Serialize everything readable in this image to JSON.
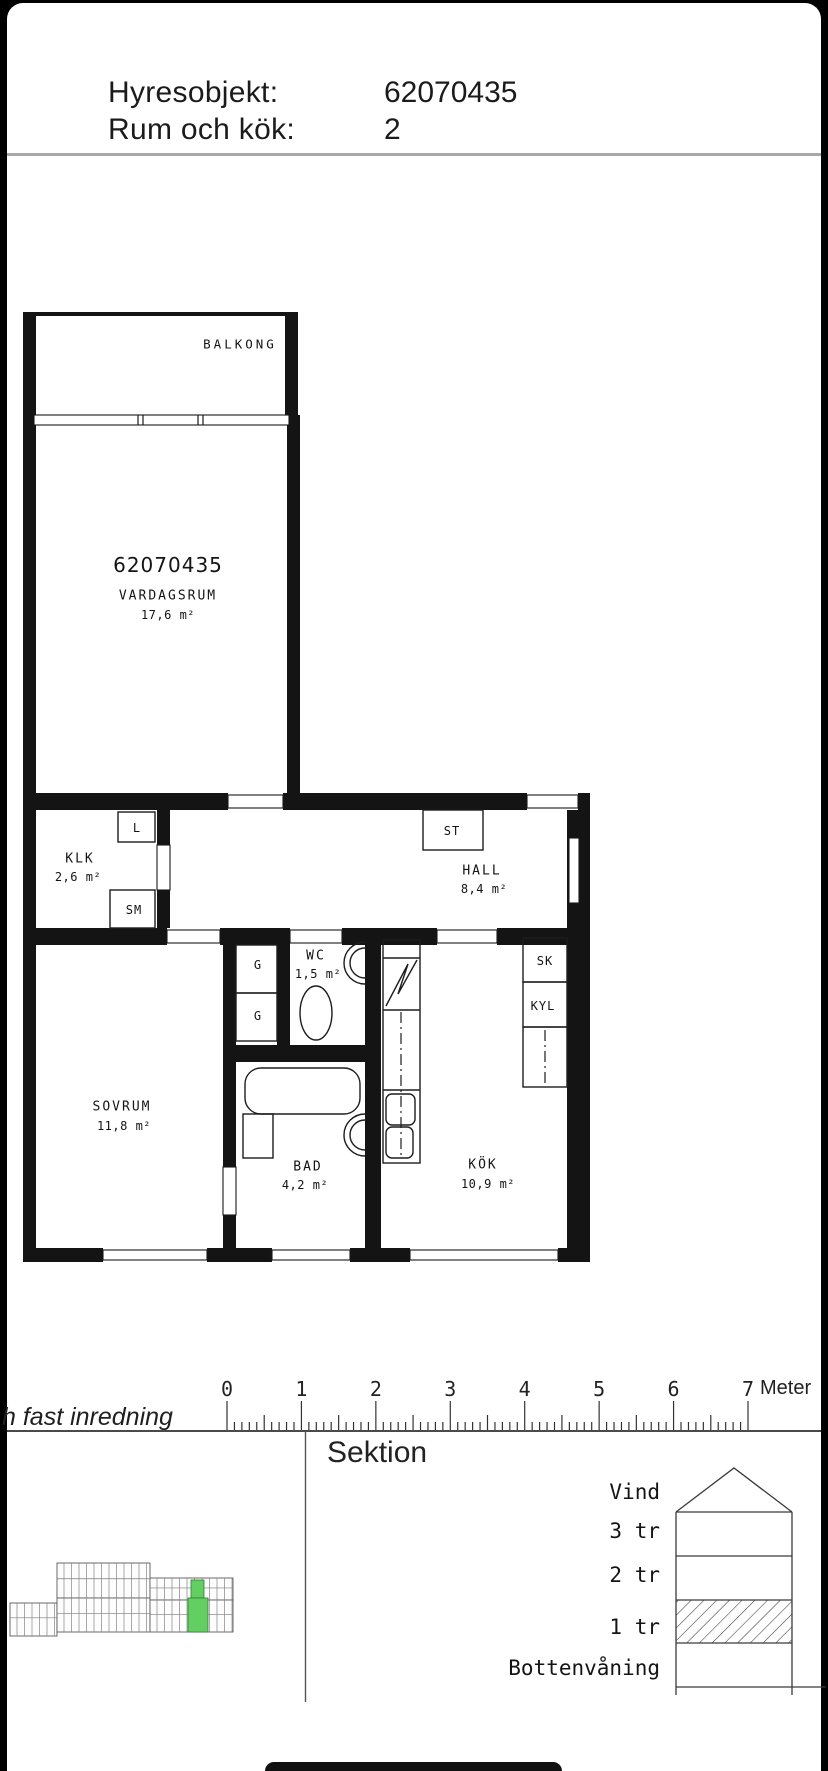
{
  "header": {
    "rows": [
      {
        "label": "Hyresobjekt:",
        "value": "62070435"
      },
      {
        "label": "Rum och kök:",
        "value": "2"
      }
    ]
  },
  "floorplan": {
    "balcony": "BALKONG",
    "apartment_number": "62070435",
    "rooms": {
      "vardagsrum": {
        "name": "VARDAGSRUM",
        "area": "17,6 m²"
      },
      "klk": {
        "name": "KLK",
        "area": "2,6 m²"
      },
      "hall": {
        "name": "HALL",
        "area": "8,4 m²"
      },
      "wc": {
        "name": "WC",
        "area": "1,5 m²"
      },
      "sovrum": {
        "name": "SOVRUM",
        "area": "11,8 m²"
      },
      "bad": {
        "name": "BAD",
        "area": "4,2 m²"
      },
      "kok": {
        "name": "KÖK",
        "area": "10,9 m²"
      }
    },
    "closets": {
      "l": "L",
      "sm": "SM",
      "st": "ST",
      "g1": "G",
      "g2": "G",
      "sk": "SK",
      "kyl": "KYL"
    }
  },
  "scale_bar": {
    "ticks": [
      "0",
      "1",
      "2",
      "3",
      "4",
      "5",
      "6",
      "7"
    ],
    "unit": "Meter"
  },
  "caption_fragment": "h fast inredning",
  "section": {
    "title": "Sektion",
    "floors": [
      "Vind",
      "3 tr",
      "2 tr",
      "1 tr",
      "Bottenvåning"
    ],
    "highlighted_floor": "1 tr"
  },
  "colors": {
    "highlight_green": "#63cf63",
    "ink": "#141414"
  }
}
